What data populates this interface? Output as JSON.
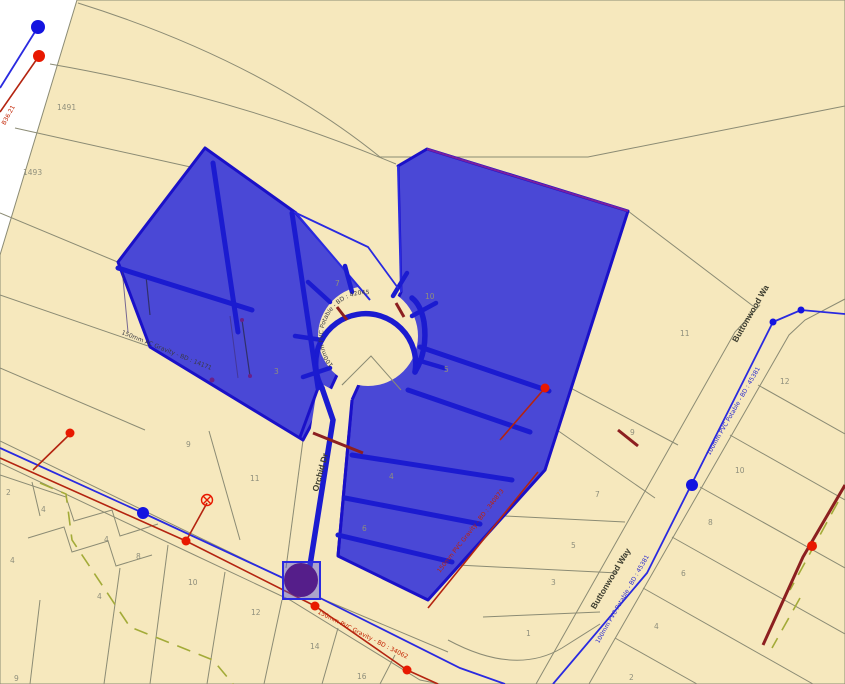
{
  "map": {
    "title": "parcel-utility-map-view",
    "streets": [
      {
        "label": "Orchid Dr"
      },
      {
        "label": "Buttonwood Way"
      },
      {
        "label": "Buttonwood Wa"
      }
    ],
    "parcels": [
      {
        "label": "1491"
      },
      {
        "label": "1493"
      },
      {
        "label": "7"
      },
      {
        "label": "10"
      },
      {
        "label": "3"
      },
      {
        "label": "5"
      },
      {
        "label": "4"
      },
      {
        "label": "6"
      },
      {
        "label": "9"
      },
      {
        "label": "11"
      },
      {
        "label": "2"
      },
      {
        "label": "4"
      },
      {
        "label": "4"
      },
      {
        "label": "4"
      },
      {
        "label": "8"
      },
      {
        "label": "4"
      },
      {
        "label": "10"
      },
      {
        "label": "12"
      },
      {
        "label": "9"
      },
      {
        "label": "14"
      },
      {
        "label": "16"
      },
      {
        "label": "11"
      },
      {
        "label": "12"
      },
      {
        "label": "9"
      },
      {
        "label": "7"
      },
      {
        "label": "10"
      },
      {
        "label": "8"
      },
      {
        "label": "5"
      },
      {
        "label": "3"
      },
      {
        "label": "1"
      },
      {
        "label": "6"
      },
      {
        "label": "4"
      },
      {
        "label": "2"
      }
    ],
    "utility_labels": [
      {
        "type": "sewer",
        "text": "150mm PVC Gravity - BD : 340873"
      },
      {
        "type": "sewer",
        "text": "150mm PVC Gravity - BD : 34062"
      },
      {
        "type": "water",
        "text": "100mm PVC Potable - BD : 45381"
      },
      {
        "type": "water",
        "text": "100mm PVC Potable - BD : 45381"
      },
      {
        "type": "water",
        "text": "100mm PVC Potable - BD : 42045"
      },
      {
        "type": "sewer",
        "text": "150mm AC Gravity - BD : 14171"
      },
      {
        "type": "sewer",
        "text": "B36.21"
      }
    ],
    "colors": {
      "land": "#f6e8bd",
      "selection_fill": "#4a48d6",
      "selection_stroke": "#1a10c8",
      "water_line": "#2222dd",
      "sewer_line": "#c22200",
      "parcel_line": "#8b8b74",
      "dashed_line": "#a3ab38",
      "selected_node": "#551e8a"
    }
  }
}
